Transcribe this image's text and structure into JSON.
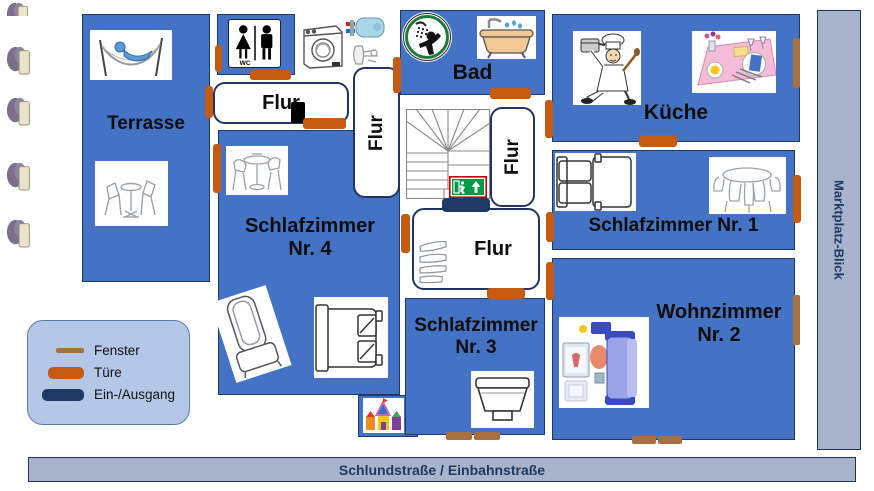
{
  "page": {
    "kind": "apartment floor plan"
  },
  "streets": {
    "right": "Marktplatz-Blick",
    "bottom": "Schlundstraße / Einbahnstraße"
  },
  "rooms": {
    "terrasse": {
      "label": "Terrasse"
    },
    "bad": {
      "label": "Bad"
    },
    "kueche": {
      "label": "Küche"
    },
    "schlafzimmer1": {
      "label": "Schlafzimmer Nr. 1"
    },
    "wohnzimmer2": {
      "label": "Wohnzimmer Nr. 2"
    },
    "schlafzimmer3": {
      "label": "Schlafzimmer Nr. 3"
    },
    "schlafzimmer4": {
      "label": "Schlafzimmer Nr. 4"
    },
    "flur_top": {
      "label": "Flur"
    },
    "flur_left": {
      "label": "Flur"
    },
    "flur_right": {
      "label": "Flur"
    },
    "flur_center": {
      "label": "Flur"
    },
    "wc": {
      "sign_text": "WC"
    }
  },
  "legend": {
    "items": [
      {
        "id": "fenster",
        "label": "Fenster",
        "color": "#A9703F"
      },
      {
        "id": "tuere",
        "label": "Türe",
        "color": "#C55A11"
      },
      {
        "id": "ein_ausgang",
        "label": "Ein-/Ausgang",
        "color": "#1F3864"
      }
    ]
  },
  "colors": {
    "room_fill": "#4472C4",
    "room_border": "#203864",
    "door": "#C55A11",
    "window": "#A9703F",
    "entrance": "#1F3864",
    "street_fill": "#A9B3CC",
    "street_text": "#1F3864",
    "legend_fill": "#B4C7E7",
    "exit_sign_green": "#009B48",
    "exit_sign_border": "#C00000"
  },
  "icons": [
    "plant-icon",
    "hammock-icon",
    "patio-chairs-icon",
    "wc-sign-icon",
    "washing-machine-icon",
    "boiler-icon",
    "sink-fixture-icon",
    "shower-sign-icon",
    "bathtub-icon",
    "chef-icon",
    "table-setting-icon",
    "bed-icon",
    "dining-chairs-icon",
    "bistro-table-icon",
    "armchair-icon",
    "living-room-icon",
    "shoe-rack-icon",
    "castle-icon",
    "stairs-icon",
    "emergency-exit-icon",
    "phone-icon"
  ]
}
